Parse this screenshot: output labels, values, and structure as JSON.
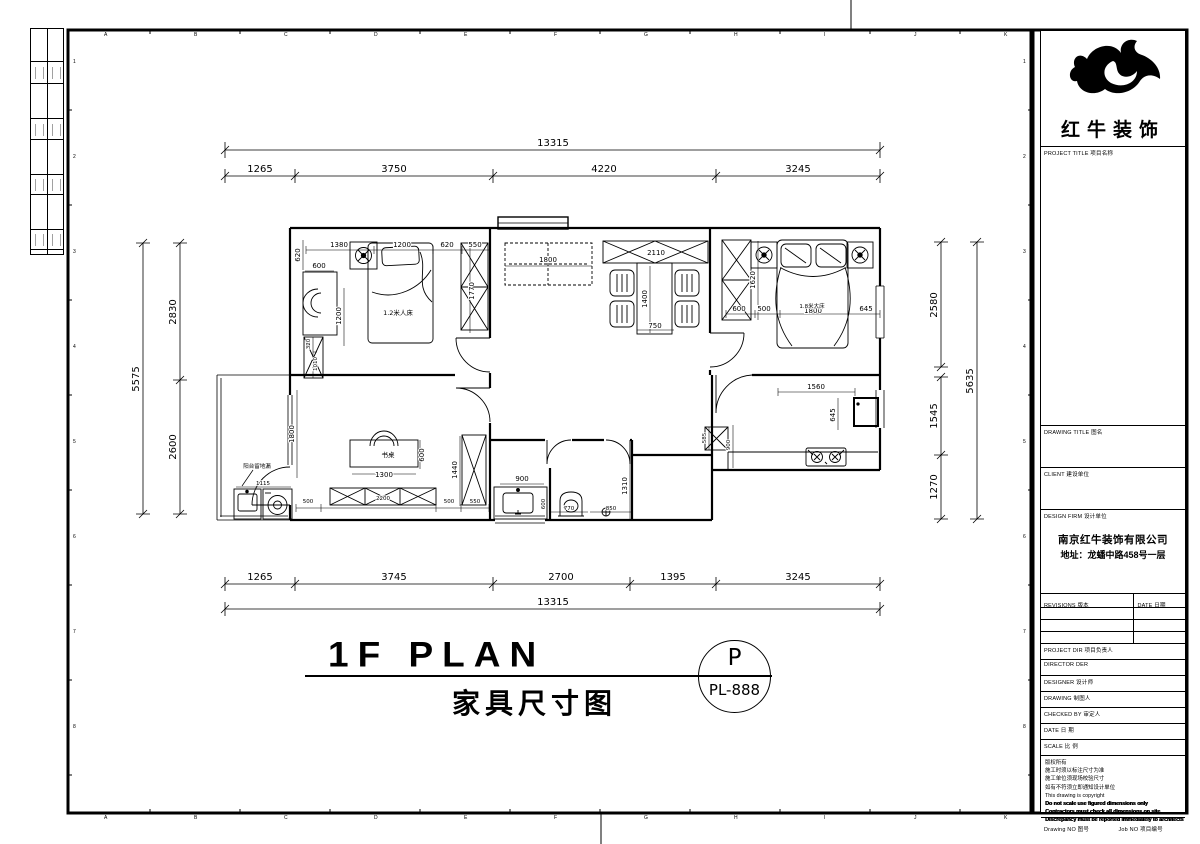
{
  "sheet": {
    "top_letters": [
      "A",
      "B",
      "C",
      "D",
      "E",
      "F",
      "G",
      "H",
      "I",
      "J",
      "K"
    ],
    "bottom_letters": [
      "A",
      "B",
      "C",
      "D",
      "E",
      "F",
      "G",
      "H",
      "I",
      "J",
      "K"
    ],
    "left_numbers": [
      "1",
      "2",
      "3",
      "4",
      "5",
      "6",
      "7",
      "8"
    ],
    "right_numbers": [
      "1",
      "2",
      "3",
      "4",
      "5",
      "6",
      "7",
      "8"
    ]
  },
  "title_block": {
    "brand_name": "红牛装饰",
    "project_title_label": "PROJECT TITLE 项目名称",
    "drawing_title_label": "DRAWING TITLE 图名",
    "client_label": "CLIENT 建设单位",
    "design_firm_label": "DESIGN FIRM 设计单位",
    "design_firm_name": "南京红牛装饰有限公司",
    "design_firm_address": "地址：龙蟠中路458号一层",
    "revisions_label": "REVISIONS 版本",
    "date_col_label": "DATE 日期",
    "project_dir_label": "PROJECT DIR 项目负责人",
    "director_label": "DIRECTOR DER",
    "designer_label": "DESIGNER 设计师",
    "drawing_by_label": "DRAWING 制图人",
    "checked_by_label": "CHECKED BY 审定人",
    "date_label": "DATE 日 期",
    "scale_label": "SCALE 比 例",
    "copyright_lines": [
      "版权所有",
      "施工时须以标注尺寸为准",
      "施工单位须现场校验尺寸",
      "如有不符须立即通知设计单位",
      "This drawing is copyright",
      "Do not scale use figured dimensions only",
      "Contractors must check all dimensions on site",
      "Discrepancy must be reported immediately to architects"
    ],
    "drawing_no_label": "Drawing NO 图号",
    "job_no_label": "Job NO 项目编号"
  },
  "plan_title": {
    "en": "1F PLAN",
    "cn": "家具尺寸图",
    "bubble_letter": "P",
    "bubble_no": "PL-888"
  },
  "labels": {
    "bed1": "1.2米人床",
    "bed2": "1.8米大床",
    "desk": "书桌",
    "balcony_note": "阳台留地漏"
  },
  "dims": {
    "top_overall": "13315",
    "top_a": "1265",
    "top_b": "3750",
    "top_c": "4220",
    "top_d": "3245",
    "left_overall": "5575",
    "left_a": "2830",
    "left_b": "2600",
    "right_overall": "5635",
    "right_a": "2580",
    "right_b": "1545",
    "right_c": "1270",
    "bot_a": "1265",
    "bot_b": "3745",
    "bot_c": "2700",
    "bot_d": "1395",
    "bot_e": "3245",
    "bot_overall": "13315",
    "b1_left620": "620",
    "b1_1380": "1380",
    "b1_bed1200": "1200",
    "b1_620": "620",
    "b1_550": "550",
    "b1_600": "600",
    "b1_desk1200": "1200",
    "b1_1770": "1770",
    "b1_320": "320",
    "b1_1010": "1010",
    "lv_1800": "1800",
    "lv_2110": "2110",
    "lv_1400": "1400",
    "lv_750": "750",
    "b2_600": "600",
    "b2_500": "500",
    "b2_1800": "1800",
    "b2_645": "645",
    "b2_1620": "1620",
    "k_1560": "1560",
    "k_645": "645",
    "k_900": "900",
    "k_585": "585",
    "ba_900": "900",
    "ba_600": "600",
    "ba_770": "770",
    "ba_850": "850",
    "ba_1310": "1310",
    "st_1800": "1800",
    "st_1300": "1300",
    "st_600": "600",
    "st_500a": "500",
    "st_2200": "2200",
    "st_500b": "500",
    "st_550": "550",
    "st_1440": "1440",
    "st_1115": "1115"
  }
}
